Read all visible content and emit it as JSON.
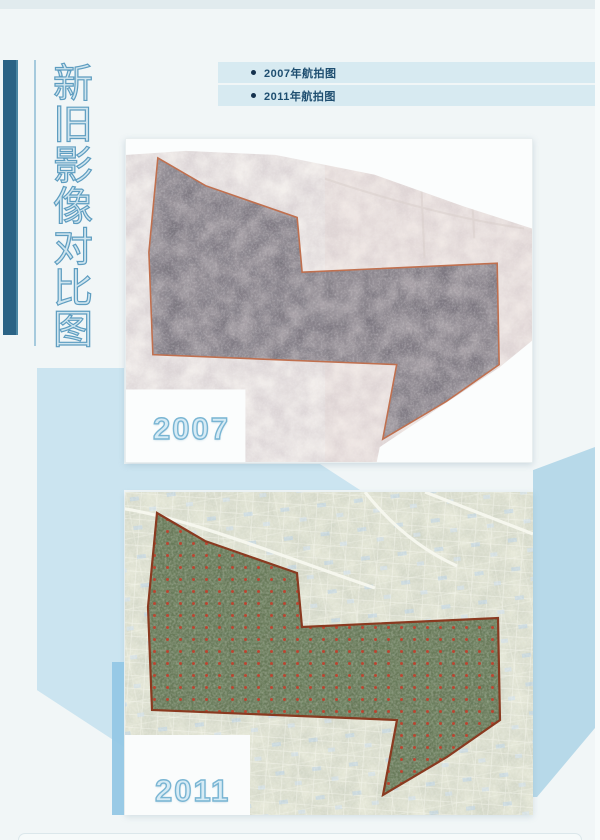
{
  "page": {
    "vertical_title": "新旧影像对比图",
    "background": "#f1f6f7",
    "accent_bar_color": "#2b6385"
  },
  "legend": {
    "items": [
      {
        "label": "2007年航拍图"
      },
      {
        "label": "2011年航拍图"
      }
    ],
    "stripe_color": "#d7eaf1",
    "text_color": "#1e4e70",
    "bullet_color": "#15324e"
  },
  "maps": [
    {
      "year_label": "2007",
      "region_outline_color": "#c0704f",
      "region_fill_color": "#6f6a74"
    },
    {
      "year_label": "2011",
      "region_outline_color": "#8a3a20",
      "region_fill_color": "#5f7150",
      "dot_color": "#c23e2b"
    }
  ],
  "decor": {
    "panel_blue": "#cbe4f0",
    "column_blue": "#b7d9e9",
    "strip_blue": "#94c7e5"
  }
}
